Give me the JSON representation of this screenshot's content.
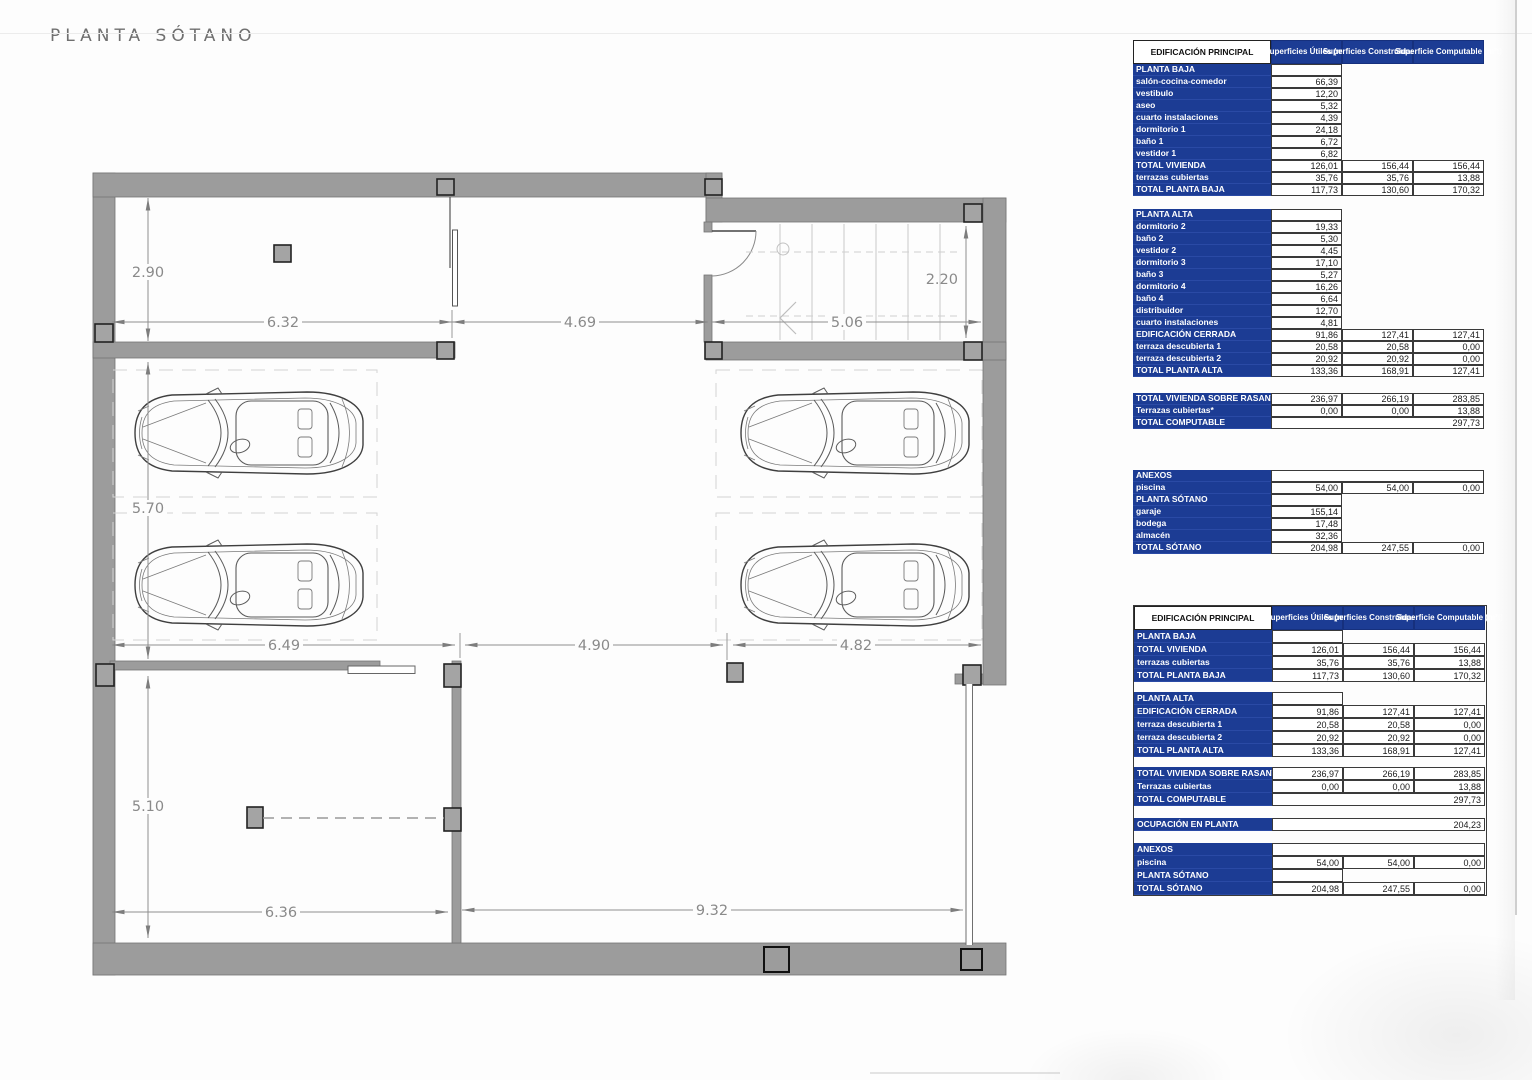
{
  "page": {
    "title": "PLANTA SÓTANO"
  },
  "plan": {
    "dims": {
      "top_left": "6.32",
      "top_mid": "4.69",
      "top_right": "5.06",
      "upper_height": "2.90",
      "stair_height": "2.20",
      "parking_height": "5.70",
      "mid_left": "6.49",
      "mid_center": "4.90",
      "mid_right": "4.82",
      "lower_height": "5.10",
      "bottom_left": "6.36",
      "bottom_right": "9.32"
    }
  },
  "tables": {
    "accent_blue": "#1c3c94",
    "detail": {
      "rows": [
        {
          "t": "head",
          "l": "EDIFICACIÓN PRINCIPAL",
          "v": [
            "Superficies Útiles (m²)",
            "Superficies Construidas (m²)",
            "Superficie Computable (m²t)"
          ]
        },
        {
          "t": "sec",
          "l": "PLANTA BAJA"
        },
        {
          "t": "item",
          "l": "salón-cocina-comedor",
          "v": [
            "66,39"
          ]
        },
        {
          "t": "item",
          "l": "vestibulo",
          "v": [
            "12,20"
          ]
        },
        {
          "t": "item",
          "l": "aseo",
          "v": [
            "5,32"
          ]
        },
        {
          "t": "item",
          "l": "cuarto instalaciones",
          "v": [
            "4,39"
          ]
        },
        {
          "t": "item",
          "l": "dormitorio 1",
          "v": [
            "24,18"
          ]
        },
        {
          "t": "item",
          "l": "baño 1",
          "v": [
            "6,72"
          ]
        },
        {
          "t": "item",
          "l": "vestidor 1",
          "v": [
            "6,82"
          ]
        },
        {
          "t": "total",
          "l": "TOTAL VIVIENDA",
          "v": [
            "126,01",
            "156,44",
            "156,44"
          ]
        },
        {
          "t": "total",
          "l": "terrazas cubiertas",
          "v": [
            "35,76",
            "35,76",
            "13,88"
          ]
        },
        {
          "t": "total",
          "l": "TOTAL PLANTA BAJA",
          "v": [
            "117,73",
            "130,60",
            "170,32"
          ]
        },
        {
          "t": "gap",
          "h": 13
        },
        {
          "t": "sec",
          "l": "PLANTA ALTA"
        },
        {
          "t": "item",
          "l": "dormitorio 2",
          "v": [
            "19,33"
          ]
        },
        {
          "t": "item",
          "l": "baño 2",
          "v": [
            "5,30"
          ]
        },
        {
          "t": "item",
          "l": "vestidor 2",
          "v": [
            "4,45"
          ]
        },
        {
          "t": "item",
          "l": "dormitorio 3",
          "v": [
            "17,10"
          ]
        },
        {
          "t": "item",
          "l": "baño 3",
          "v": [
            "5,27"
          ]
        },
        {
          "t": "item",
          "l": "dormitorio 4",
          "v": [
            "16,26"
          ]
        },
        {
          "t": "item",
          "l": "baño 4",
          "v": [
            "6,64"
          ]
        },
        {
          "t": "item",
          "l": "distribuidor",
          "v": [
            "12,70"
          ]
        },
        {
          "t": "item",
          "l": "cuarto instalaciones",
          "v": [
            "4,81"
          ]
        },
        {
          "t": "total",
          "l": "EDIFICACIÓN CERRADA",
          "v": [
            "91,86",
            "127,41",
            "127,41"
          ]
        },
        {
          "t": "total",
          "l": "terraza descubierta 1",
          "v": [
            "20,58",
            "20,58",
            "0,00"
          ]
        },
        {
          "t": "total",
          "l": "terraza descubierta 2",
          "v": [
            "20,92",
            "20,92",
            "0,00"
          ]
        },
        {
          "t": "total",
          "l": "TOTAL PLANTA ALTA",
          "v": [
            "133,36",
            "168,91",
            "127,41"
          ]
        },
        {
          "t": "gap",
          "h": 16
        },
        {
          "t": "total",
          "l": "TOTAL VIVIENDA SOBRE RASANTE",
          "v": [
            "236,97",
            "266,19",
            "283,85"
          ]
        },
        {
          "t": "total",
          "l": "Terrazas cubiertas*",
          "v": [
            "0,00",
            "0,00",
            "13,88"
          ]
        },
        {
          "t": "span",
          "l": "TOTAL COMPUTABLE",
          "v": [
            "297,73"
          ]
        },
        {
          "t": "gap",
          "h": 41
        },
        {
          "t": "span",
          "l": "ANEXOS",
          "v": [
            ""
          ]
        },
        {
          "t": "total",
          "l": "piscina",
          "v": [
            "54,00",
            "54,00",
            "0,00"
          ]
        },
        {
          "t": "sec",
          "l": "PLANTA SÓTANO"
        },
        {
          "t": "item",
          "l": "garaje",
          "v": [
            "155,14"
          ]
        },
        {
          "t": "item",
          "l": "bodega",
          "v": [
            "17,48"
          ]
        },
        {
          "t": "item",
          "l": "almacén",
          "v": [
            "32,36"
          ]
        },
        {
          "t": "total",
          "l": "TOTAL SÓTANO",
          "v": [
            "204,98",
            "247,55",
            "0,00"
          ]
        }
      ]
    },
    "summary": {
      "rows": [
        {
          "t": "head",
          "l": "EDIFICACIÓN PRINCIPAL",
          "v": [
            "Superficies Útiles (m²)",
            "Superficies Construidas (m²)",
            "Superficie Computable (m²t)"
          ]
        },
        {
          "t": "sec",
          "l": "PLANTA BAJA"
        },
        {
          "t": "total",
          "l": "TOTAL VIVIENDA",
          "v": [
            "126,01",
            "156,44",
            "156,44"
          ]
        },
        {
          "t": "total",
          "l": "terrazas cubiertas",
          "v": [
            "35,76",
            "35,76",
            "13,88"
          ]
        },
        {
          "t": "total",
          "l": "TOTAL PLANTA BAJA",
          "v": [
            "117,73",
            "130,60",
            "170,32"
          ]
        },
        {
          "t": "gap",
          "h": 10
        },
        {
          "t": "sec",
          "l": "PLANTA ALTA"
        },
        {
          "t": "total",
          "l": "EDIFICACIÓN CERRADA",
          "v": [
            "91,86",
            "127,41",
            "127,41"
          ]
        },
        {
          "t": "total",
          "l": "terraza descubierta 1",
          "v": [
            "20,58",
            "20,58",
            "0,00"
          ]
        },
        {
          "t": "total",
          "l": "terraza descubierta 2",
          "v": [
            "20,92",
            "20,92",
            "0,00"
          ]
        },
        {
          "t": "total",
          "l": "TOTAL PLANTA ALTA",
          "v": [
            "133,36",
            "168,91",
            "127,41"
          ]
        },
        {
          "t": "gap",
          "h": 10
        },
        {
          "t": "total",
          "l": "TOTAL VIVIENDA SOBRE RASANTE",
          "v": [
            "236,97",
            "266,19",
            "283,85"
          ]
        },
        {
          "t": "total",
          "l": "Terrazas cubiertas",
          "v": [
            "0,00",
            "0,00",
            "13,88"
          ]
        },
        {
          "t": "span",
          "l": "TOTAL COMPUTABLE",
          "v": [
            "297,73"
          ]
        },
        {
          "t": "gap",
          "h": 12
        },
        {
          "t": "span",
          "l": "OCUPACIÓN EN PLANTA",
          "v": [
            "204,23"
          ]
        },
        {
          "t": "gap",
          "h": 12
        },
        {
          "t": "span",
          "l": "ANEXOS",
          "v": [
            ""
          ]
        },
        {
          "t": "total",
          "l": "piscina",
          "v": [
            "54,00",
            "54,00",
            "0,00"
          ]
        },
        {
          "t": "sec",
          "l": "PLANTA SÓTANO"
        },
        {
          "t": "total",
          "l": "TOTAL SÓTANO",
          "v": [
            "204,98",
            "247,55",
            "0,00"
          ]
        }
      ]
    }
  }
}
